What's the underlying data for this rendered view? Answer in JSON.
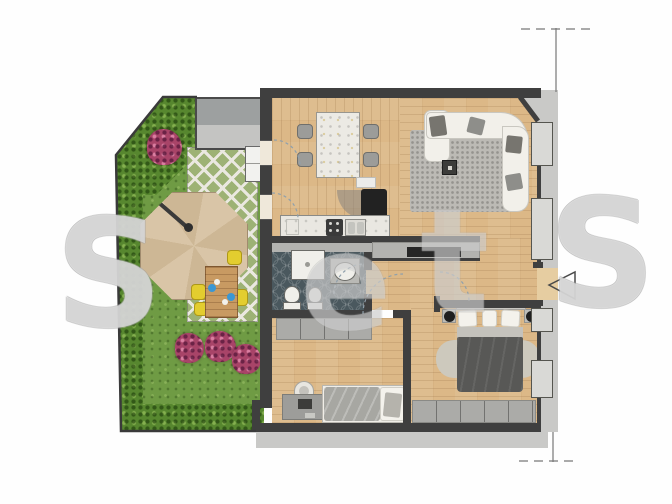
{
  "watermark": {
    "letters": [
      "S",
      "e",
      "t",
      "S"
    ]
  },
  "colors": {
    "wood": "#dcb887",
    "wood_light": "#e6cda1",
    "wall": "#3f3f3f",
    "exterior": "#c9c9c7",
    "grass": "#6f9b44",
    "hedge": "#57872f",
    "lattice_bg": "#9db275",
    "lattice_line": "#eae8e0",
    "tile": "#4a585e",
    "parasol": "#d9c5a7",
    "parasol_dark": "#cdb795",
    "garden_table": "#c89a62",
    "chair_yellow": "#e3cd2f",
    "flower": "#a84468",
    "accent_blue": "#3b97d3",
    "sofa": "#f2f0ea",
    "cushion": "#8e8e8a",
    "rug": "#bcbab5",
    "duvet": "#585856",
    "duvet_light": "#a7a7a2",
    "pillow": "#f4f2ec",
    "cabinet": "#ababa8",
    "sideboard": "#b3b3b0",
    "counter": "#e9e7e1",
    "marble": "#eceae4",
    "tv": "#262626",
    "fridge": "#222222",
    "fixture": "#f0efea",
    "window_panel": "#d9d9d6",
    "dim_line": "#777777",
    "arc": "#90a0ac"
  }
}
